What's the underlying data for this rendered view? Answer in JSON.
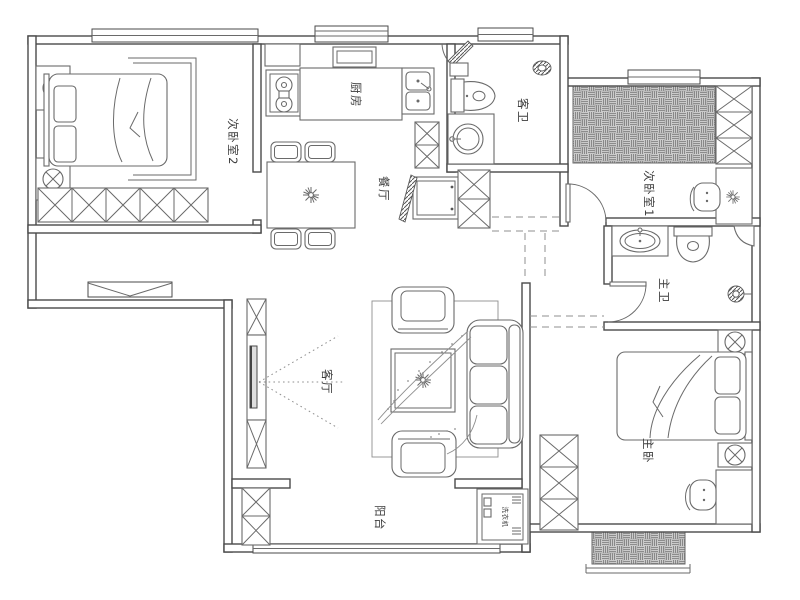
{
  "plan": {
    "type": "apartment-floor-plan",
    "background": "#ffffff",
    "colors": {
      "wall_line": "#4a4a4a",
      "furniture_line": "#6a6a6a",
      "hatch_fill": "#cbcbcb",
      "label_text": "#3c3c3c",
      "dash_line": "#8f8f8f"
    },
    "rooms": {
      "bedroom2": {
        "label": "次卧室2"
      },
      "kitchen": {
        "label": "厨房"
      },
      "dining": {
        "label": "餐厅"
      },
      "guest_bathroom": {
        "label": "客卫"
      },
      "bedroom1": {
        "label": "次卧室1"
      },
      "master_bathroom": {
        "label": "主卫"
      },
      "master_bedroom": {
        "label": "主卧"
      },
      "living_room": {
        "label": "客厅"
      },
      "balcony": {
        "label": "阳台"
      }
    },
    "appliances": {
      "washing_machine": {
        "label": "洗衣机"
      }
    },
    "symbols": {
      "bed": "mattress-with-pillows-shape",
      "nightstand_lamp": "circle-with-x",
      "wardrobe": "box-with-diagonal-cross",
      "stove": "rect-with-two-burners",
      "kitchen_sink": "double-basin-rect",
      "dining_table": "rect-with-four-chairs",
      "plant": "asterisk-star",
      "toilet": "tank-and-bowl-shape",
      "washbasin": "circle-or-oval-in-counter",
      "floor_drain": "hatched-circle",
      "tatami": "basket-weave-hatch",
      "tv": "thin-panel-with-sight-lines",
      "sofa": "rounded-rect-with-cushions",
      "window": "triple-parallel-lines",
      "door": "leaf-with-quarter-arc",
      "entry_door": "hatched-leaf-panel"
    }
  }
}
